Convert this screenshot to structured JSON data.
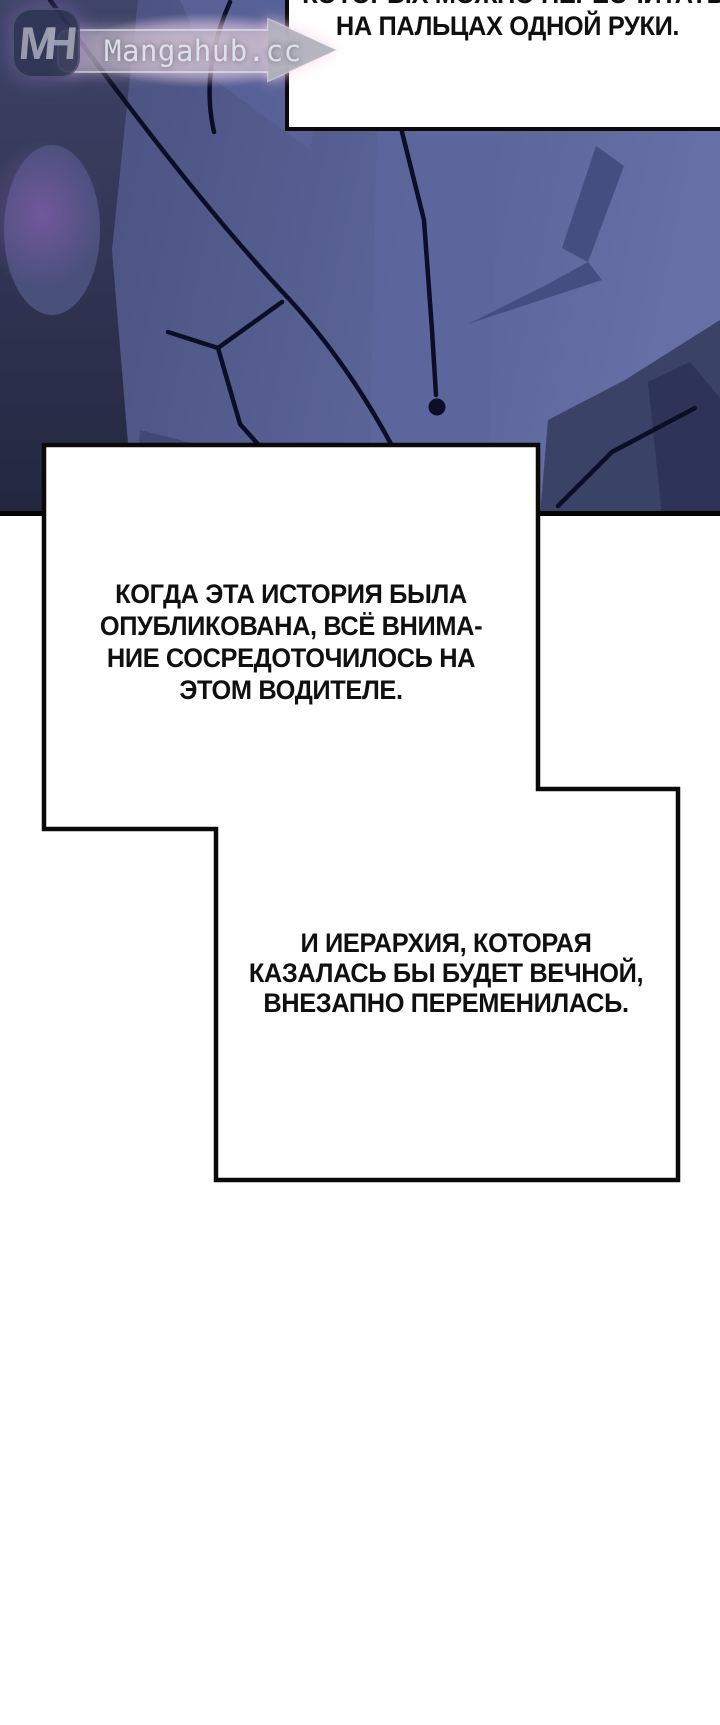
{
  "watermark": {
    "logo": "MH",
    "site": "Mangahub.cc"
  },
  "bubbles": {
    "top": {
      "line1": "КОТОРЫХ МОЖНО ПЕРЕСЧИТАТЬ",
      "line2": "НА ПАЛЬЦАХ ОДНОЙ РУКИ."
    },
    "middle": {
      "line1": "КОГДА ЭТА ИСТОРИЯ БЫЛА",
      "line2": "ОПУБЛИКОВАНА, ВСЁ ВНИМА-",
      "line3": "НИЕ СОСРЕДОТОЧИЛОСЬ НА",
      "line4": "ЭТОМ ВОДИТЕЛЕ."
    },
    "bottom": {
      "line1": "И ИЕРАРХИЯ, КОТОРАЯ",
      "line2": "КАЗАЛАСЬ БЫ БУДЕТ ВЕЧНОЙ,",
      "line3": "ВНЕЗАПНО ПЕРЕМЕНИЛАСЬ."
    }
  },
  "colors": {
    "suit_base": "#555d90",
    "suit_light": "#6670a6",
    "suit_shadow": "#454e80",
    "suit_dark": "#262b4d",
    "outline": "#0b0f26",
    "panel_border": "#060606",
    "bubble_bg": "#ffffff",
    "text": "#101010",
    "watermark_glow": "#ffd6eb"
  }
}
